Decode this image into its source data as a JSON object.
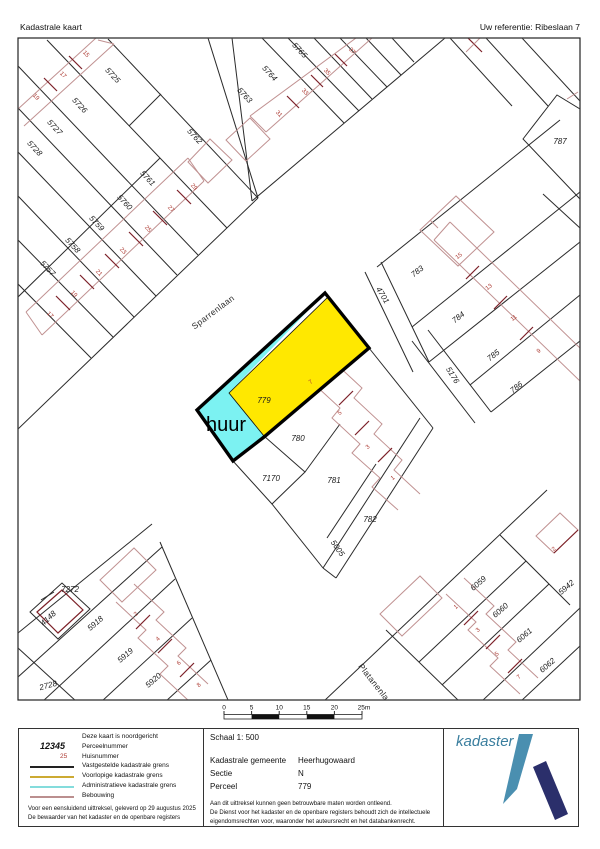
{
  "header": {
    "title": "Kadastrale kaart",
    "reference": "Uw referentie: Ribeslaan 7"
  },
  "map": {
    "streets": {
      "sparrenlaan": "Sparrenlaan",
      "platanenlaan": "Platanenlaan"
    },
    "lease_label": "huur",
    "colors": {
      "parcel_fill": "#FFE800",
      "lease_fill": "#7CF2F2",
      "house_number": "#AD3A32"
    },
    "parcels": {
      "p5725": "5725",
      "p5726": "5726",
      "p5727": "5727",
      "p5728": "5728",
      "p5757": "5757",
      "p5758": "5758",
      "p5759": "5759",
      "p5760": "5760",
      "p5761": "5761",
      "p5762": "5762",
      "p5763": "5763",
      "p5764": "5764",
      "p5765": "5765",
      "p787": "787",
      "p4701": "4701",
      "p783": "783",
      "p784": "784",
      "p785": "785",
      "p786": "786",
      "p5176": "5176",
      "p779": "779",
      "p780": "780",
      "p781": "781",
      "p782": "782",
      "p7170": "7170",
      "p5005": "5005",
      "p5918": "5918",
      "p5919": "5919",
      "p5920": "5920",
      "p2728": "2728",
      "p4148": "4148",
      "p7272": "7272",
      "p6059": "6059",
      "p6060": "6060",
      "p6061": "6061",
      "p6062": "6062",
      "p5942": "5942"
    },
    "houses": {
      "nw": [
        "15",
        "17",
        "19"
      ],
      "w": [
        "17",
        "19",
        "21",
        "23",
        "25",
        "27",
        "29"
      ],
      "n": [
        "31",
        "33",
        "35",
        "37"
      ],
      "e": [
        "15",
        "13",
        "11",
        "9"
      ],
      "c": [
        "7",
        "5",
        "3",
        "1"
      ],
      "sw": [
        "2",
        "4",
        "6",
        "8"
      ],
      "se": [
        "1",
        "3",
        "5",
        "7",
        "2"
      ]
    }
  },
  "scalebar": {
    "labels": [
      "0",
      "5",
      "10",
      "15",
      "20",
      "25m"
    ]
  },
  "legend": {
    "north_note": "Deze kaart is noordgericht",
    "parcel_sample": "12345",
    "parcel_label": "Perceelnummer",
    "house_sample": "25",
    "house_label": "Huisnummer",
    "lines": [
      {
        "label": "Vastgestelde kadastrale grens",
        "color": "#222222"
      },
      {
        "label": "Voorlopige kadastrale grens",
        "color": "#CCAA33"
      },
      {
        "label": "Administratieve kadastrale grens",
        "color": "#84DCDC"
      },
      {
        "label": "Bebouwing",
        "color": "#BB8F8F"
      }
    ],
    "footer1": "Voor een eensluidend uittreksel, geleverd op 29 augustus 2025",
    "footer2": "De bewaarder van het kadaster en de openbare registers"
  },
  "info": {
    "scale": "Schaal 1: 500",
    "rows": [
      {
        "label": "Kadastrale gemeente",
        "value": "Heerhugowaard"
      },
      {
        "label": "Sectie",
        "value": "N"
      },
      {
        "label": "Perceel",
        "value": "779"
      }
    ],
    "disclaimer1": "Aan dit uittreksel kunnen geen betrouwbare maten worden ontleend.",
    "disclaimer2": "De Dienst voor het kadaster en de openbare registers behoudt zich de intellectuele",
    "disclaimer3": "eigendomsrechten voor, waaronder het auteursrecht en het databankenrecht."
  },
  "logo": {
    "wordmark": "kadaster",
    "colors": {
      "wordmark": "#3A7E9E",
      "blade": "#4A8FB0",
      "stroke": "#2B2F6B"
    }
  }
}
